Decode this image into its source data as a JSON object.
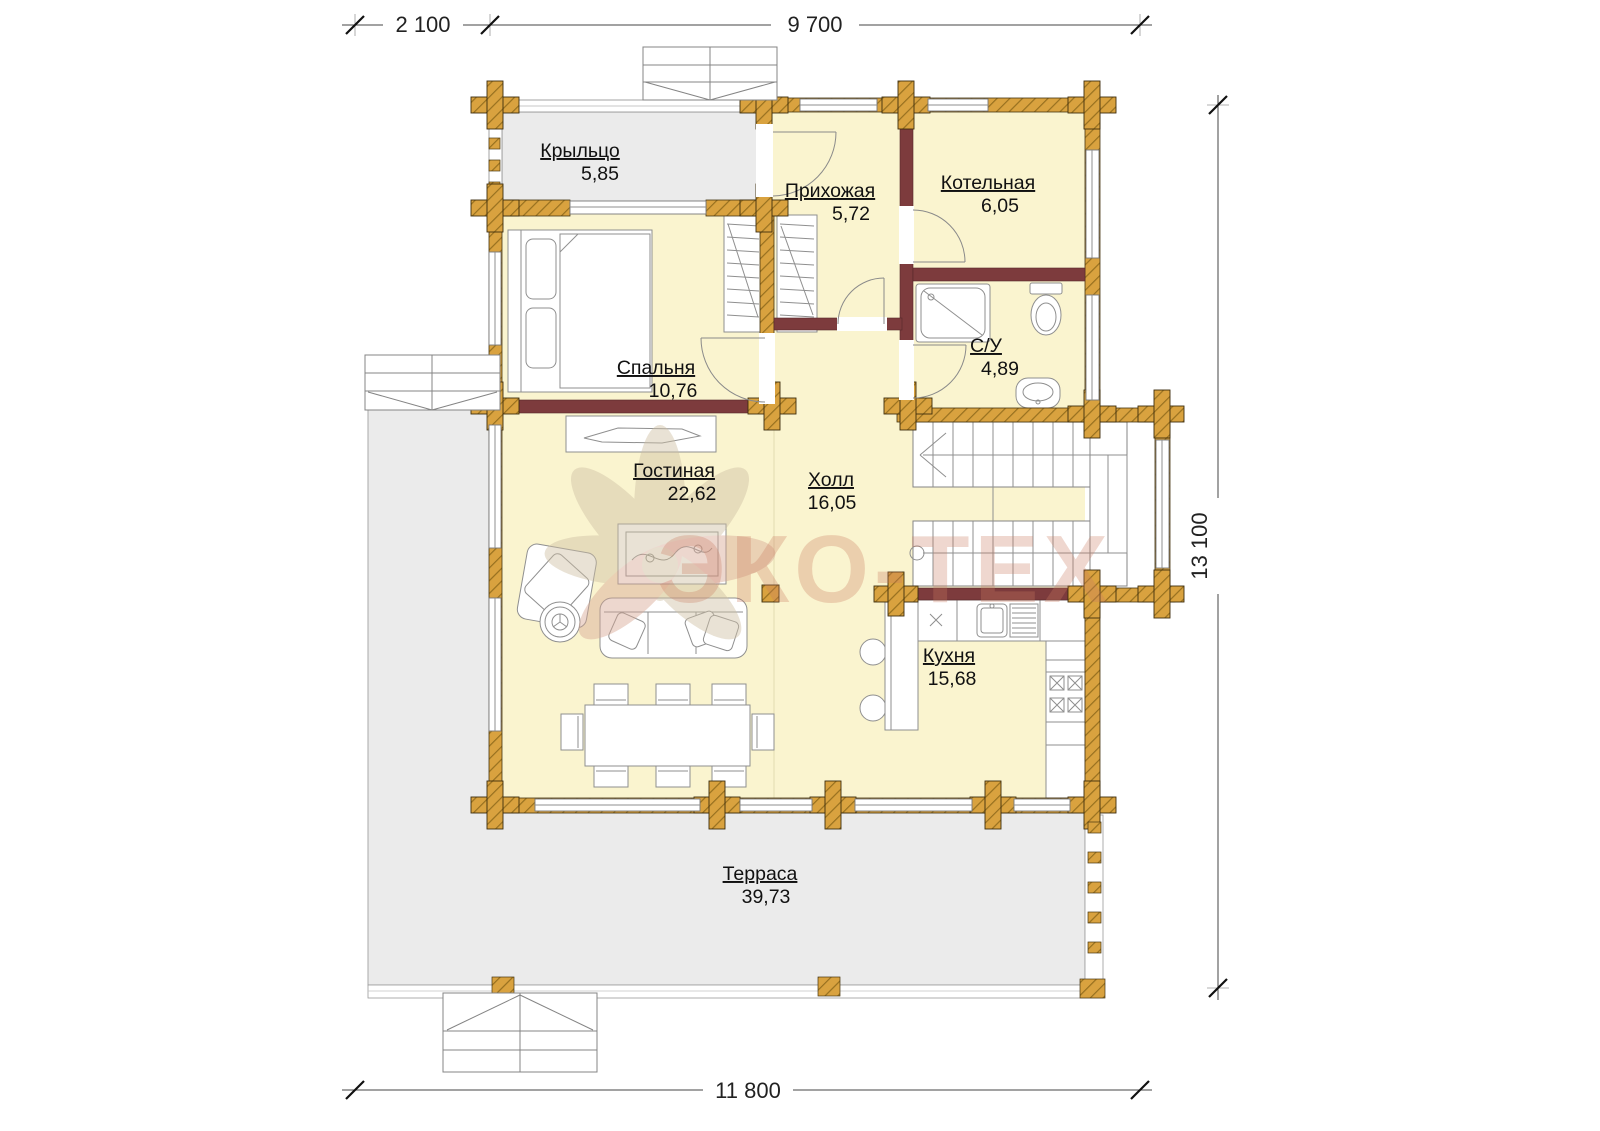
{
  "plan": {
    "title": "Floor plan — first floor",
    "watermark": "ЭКО-ТЕХ",
    "rooms": [
      {
        "name": "Крыльцо",
        "area": "5,85"
      },
      {
        "name": "Прихожая",
        "area": "5,72"
      },
      {
        "name": "Котельная",
        "area": "6,05"
      },
      {
        "name": "Спальня",
        "area": "10,76"
      },
      {
        "name": "С/У",
        "area": "4,89"
      },
      {
        "name": "Гостиная",
        "area": "22,62"
      },
      {
        "name": "Холл",
        "area": "16,05"
      },
      {
        "name": "Кухня",
        "area": "15,68"
      },
      {
        "name": "Терраса",
        "area": "39,73"
      }
    ],
    "dimensions": {
      "top_left": "2 100",
      "top_right": "9 700",
      "right_side": "13 100",
      "bottom": "11 800"
    },
    "colors": {
      "room_fill": "#faf4cf",
      "outdoor_fill": "#ebebeb",
      "log_wall": "#d9a23f",
      "partition_wall": "#7d3b3d",
      "watermark_pink": "#c9795f"
    }
  }
}
